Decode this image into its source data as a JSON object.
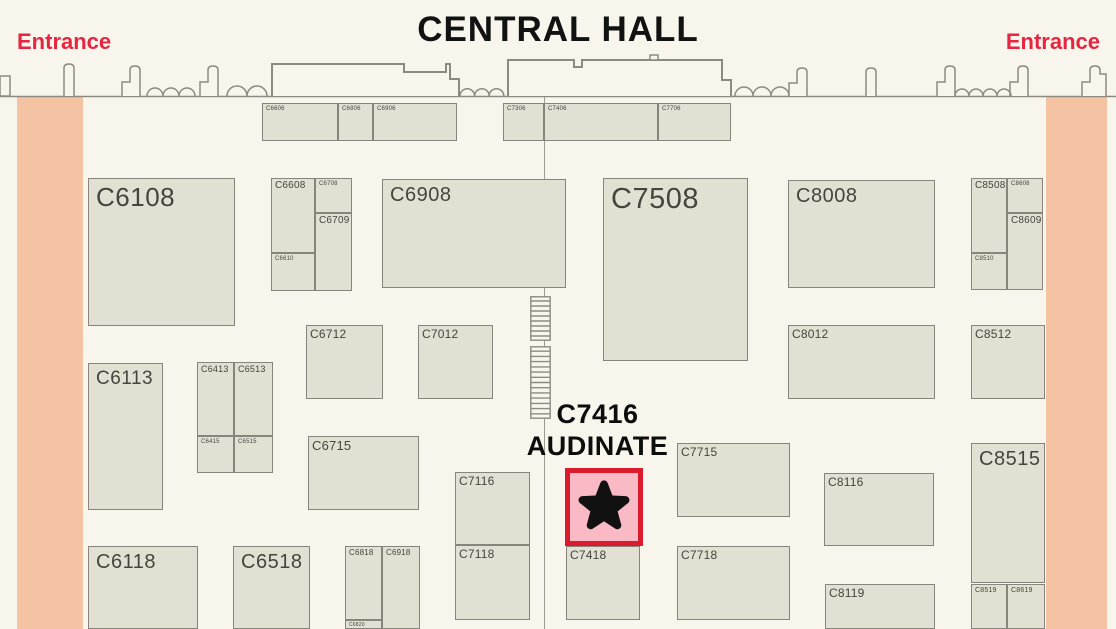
{
  "title": "CENTRAL HALL",
  "entrances": {
    "left": "Entrance",
    "right": "Entrance"
  },
  "highlight": {
    "line1": "C7416",
    "line2": "AUDINATE",
    "marker": "black-star-icon",
    "box": {
      "x": 565,
      "y": 468,
      "w": 78,
      "h": 78
    }
  },
  "colors": {
    "background": "#f7f5ec",
    "booth_fill": "#e1e0d3",
    "booth_border": "#85857b",
    "booth_text": "#45453e",
    "corridor": "#f4c3a3",
    "wall": "#8b8b82",
    "accent_red": "#e62640",
    "title_text": "#121212",
    "highlight_fill": "#f9bac5",
    "highlight_border": "#da1b2e"
  },
  "map": {
    "corridors": [
      {
        "side": "left",
        "x": 17,
        "y": 97,
        "w": 66,
        "h": 532
      },
      {
        "side": "right",
        "x": 1046,
        "y": 97,
        "w": 61,
        "h": 532
      }
    ],
    "aisle_line": {
      "x": 544,
      "y": 97,
      "h": 532
    },
    "stairs": [
      {
        "x": 530,
        "y": 296,
        "w": 21,
        "h": 45,
        "rungs": 8
      },
      {
        "x": 530,
        "y": 346,
        "w": 21,
        "h": 73,
        "rungs": 13
      }
    ],
    "booths": [
      {
        "label": "C6606",
        "x": 262,
        "y": 103,
        "w": 76,
        "h": 38,
        "fs": 6
      },
      {
        "label": "C6806",
        "x": 338,
        "y": 103,
        "w": 35,
        "h": 38,
        "fs": 6
      },
      {
        "label": "C6906",
        "x": 373,
        "y": 103,
        "w": 84,
        "h": 38,
        "fs": 6
      },
      {
        "label": "C7306",
        "x": 503,
        "y": 103,
        "w": 41,
        "h": 38,
        "fs": 6
      },
      {
        "label": "C7406",
        "x": 544,
        "y": 103,
        "w": 114,
        "h": 38,
        "fs": 6
      },
      {
        "label": "C7706",
        "x": 658,
        "y": 103,
        "w": 73,
        "h": 38,
        "fs": 6
      },
      {
        "label": "C6108",
        "x": 88,
        "y": 178,
        "w": 147,
        "h": 148,
        "fs": 26
      },
      {
        "label": "C6608",
        "x": 271,
        "y": 178,
        "w": 44,
        "h": 75,
        "fs": 10
      },
      {
        "label": "C6708",
        "x": 315,
        "y": 178,
        "w": 37,
        "h": 35,
        "fs": 6
      },
      {
        "label": "C6709",
        "x": 315,
        "y": 213,
        "w": 37,
        "h": 78,
        "fs": 10
      },
      {
        "label": "C6610",
        "x": 271,
        "y": 253,
        "w": 44,
        "h": 38,
        "fs": 6
      },
      {
        "label": "C6908",
        "x": 382,
        "y": 179,
        "w": 184,
        "h": 109,
        "fs": 20
      },
      {
        "label": "C7508",
        "x": 603,
        "y": 178,
        "w": 145,
        "h": 183,
        "fs": 29
      },
      {
        "label": "C8008",
        "x": 788,
        "y": 180,
        "w": 147,
        "h": 108,
        "fs": 20
      },
      {
        "label": "C8508",
        "x": 971,
        "y": 178,
        "w": 36,
        "h": 75,
        "fs": 10
      },
      {
        "label": "C8608",
        "x": 1007,
        "y": 178,
        "w": 36,
        "h": 35,
        "fs": 6
      },
      {
        "label": "C8609",
        "x": 1007,
        "y": 213,
        "w": 36,
        "h": 77,
        "fs": 10
      },
      {
        "label": "C8510",
        "x": 971,
        "y": 253,
        "w": 36,
        "h": 37,
        "fs": 6
      },
      {
        "label": "C6712",
        "x": 306,
        "y": 325,
        "w": 77,
        "h": 74,
        "fs": 12
      },
      {
        "label": "C7012",
        "x": 418,
        "y": 325,
        "w": 75,
        "h": 74,
        "fs": 12
      },
      {
        "label": "C8012",
        "x": 788,
        "y": 325,
        "w": 147,
        "h": 74,
        "fs": 12
      },
      {
        "label": "C8512",
        "x": 971,
        "y": 325,
        "w": 74,
        "h": 74,
        "fs": 12
      },
      {
        "label": "C6113",
        "x": 88,
        "y": 363,
        "w": 75,
        "h": 147,
        "fs": 19
      },
      {
        "label": "C6413",
        "x": 197,
        "y": 362,
        "w": 37,
        "h": 74,
        "fs": 9
      },
      {
        "label": "C6513",
        "x": 234,
        "y": 362,
        "w": 39,
        "h": 74,
        "fs": 9
      },
      {
        "label": "C6415",
        "x": 197,
        "y": 436,
        "w": 37,
        "h": 37,
        "fs": 6
      },
      {
        "label": "C6515",
        "x": 234,
        "y": 436,
        "w": 39,
        "h": 37,
        "fs": 6
      },
      {
        "label": "C6715",
        "x": 308,
        "y": 436,
        "w": 111,
        "h": 74,
        "fs": 13
      },
      {
        "label": "C7116",
        "x": 455,
        "y": 472,
        "w": 75,
        "h": 73,
        "fs": 12
      },
      {
        "label": "C7715",
        "x": 677,
        "y": 443,
        "w": 113,
        "h": 74,
        "fs": 12
      },
      {
        "label": "C8116",
        "x": 824,
        "y": 473,
        "w": 110,
        "h": 73,
        "fs": 12
      },
      {
        "label": "C8515",
        "x": 971,
        "y": 443,
        "w": 74,
        "h": 140,
        "fs": 20
      },
      {
        "label": "C6118",
        "x": 88,
        "y": 546,
        "w": 110,
        "h": 83,
        "fs": 20
      },
      {
        "label": "C6518",
        "x": 233,
        "y": 546,
        "w": 77,
        "h": 83,
        "fs": 20
      },
      {
        "label": "C6818",
        "x": 345,
        "y": 546,
        "w": 37,
        "h": 74,
        "fs": 8
      },
      {
        "label": "C6918",
        "x": 382,
        "y": 546,
        "w": 38,
        "h": 83,
        "fs": 8
      },
      {
        "label": "C6820",
        "x": 345,
        "y": 620,
        "w": 37,
        "h": 9,
        "fs": 5
      },
      {
        "label": "C7118",
        "x": 455,
        "y": 545,
        "w": 75,
        "h": 75,
        "fs": 12
      },
      {
        "label": "C7418",
        "x": 566,
        "y": 546,
        "w": 74,
        "h": 74,
        "fs": 12
      },
      {
        "label": "C7718",
        "x": 677,
        "y": 546,
        "w": 113,
        "h": 74,
        "fs": 12
      },
      {
        "label": "C8119",
        "x": 825,
        "y": 584,
        "w": 110,
        "h": 45,
        "fs": 12
      },
      {
        "label": "C8519",
        "x": 971,
        "y": 584,
        "w": 36,
        "h": 45,
        "fs": 7
      },
      {
        "label": "C8619",
        "x": 1007,
        "y": 584,
        "w": 38,
        "h": 45,
        "fs": 7
      }
    ]
  }
}
